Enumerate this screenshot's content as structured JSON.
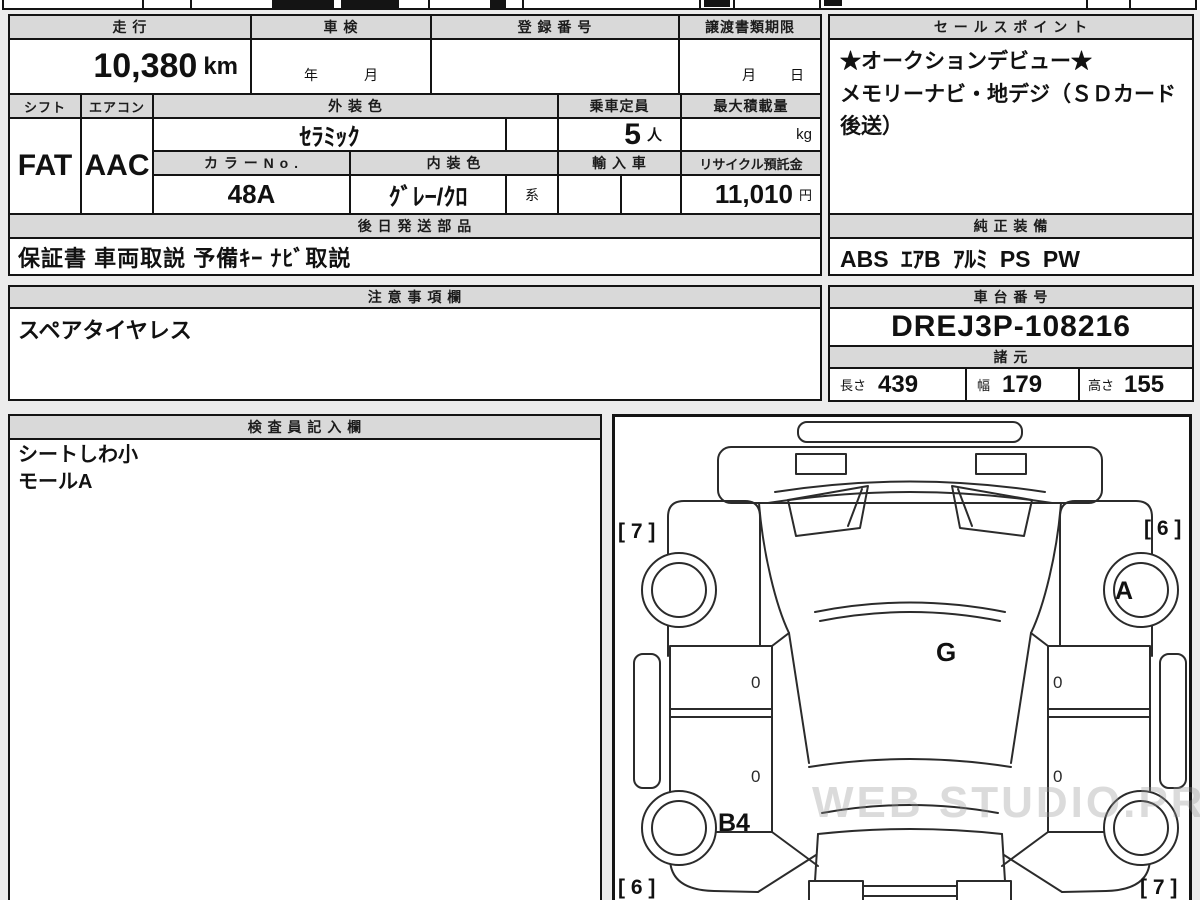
{
  "sections": {
    "mileage": {
      "label": "走 行",
      "value": "10,380",
      "unit": "km"
    },
    "inspection": {
      "label": "車 検",
      "year": "年",
      "month": "月"
    },
    "registration": {
      "label": "登 録 番 号",
      "value": ""
    },
    "deadline": {
      "label": "譲渡書類期限",
      "month": "月",
      "day": "日"
    },
    "shift": {
      "label": "シフト",
      "value": "FAT"
    },
    "aircon": {
      "label": "エアコン",
      "value": "AAC"
    },
    "exterior_color": {
      "label": "外 装 色",
      "value": "ｾﾗﾐｯｸ"
    },
    "capacity": {
      "label": "乗車定員",
      "value": "5",
      "unit": "人"
    },
    "max_load": {
      "label": "最大積載量",
      "value": "",
      "unit": "kg"
    },
    "color_no": {
      "label": "カ ラ ー N o .",
      "value": "48A"
    },
    "interior_color": {
      "label": "内 装 色",
      "value": "ｸﾞﾚｰ/ｸﾛ",
      "suffix": "系"
    },
    "import_car": {
      "label": "輸 入 車",
      "value": ""
    },
    "recycle_deposit": {
      "label": "リサイクル預託金",
      "value": "11,010",
      "unit": "円"
    },
    "shipped_later_parts": {
      "label": "後 日 発 送 部 品",
      "value": "保証書 車両取説 予備ｷｰ ﾅﾋﾞ取説"
    },
    "sales_points": {
      "label": "セ ー ル ス ポ イ ン ト",
      "line1": "★オークションデビュー★",
      "line2": "メモリーナビ・地デジ（ＳＤカード後送）"
    },
    "genuine_equipment": {
      "label": "純 正 装 備",
      "value": "ABS ｴｱB ｱﾙﾐ PS PW"
    },
    "notes": {
      "label": "注 意 事 項 欄",
      "value": "スペアタイヤレス"
    },
    "chassis_no": {
      "label": "車 台 番 号",
      "value": "DREJ3P-108216"
    },
    "specs": {
      "label": "諸 元",
      "length_label": "長さ",
      "length": "439",
      "width_label": "幅",
      "width": "179",
      "height_label": "高さ",
      "height": "155"
    },
    "inspector_notes": {
      "label": "検 査 員 記 入 欄",
      "line1": "シートしわ小",
      "line2": "モールA"
    }
  },
  "diagram": {
    "front_left": "[ 7 ]",
    "front_right": "[ 6 ]",
    "front_wheel": "A",
    "center": "G",
    "rear_quarter": "B4",
    "rear_left": "[ 6 ]",
    "rear_right": "[ 7 ]",
    "door_mark": "0"
  },
  "watermark": "WEB STUDIO.PRO",
  "colors": {
    "border": "#141414",
    "header_bg": "#d9d9d9",
    "page_bg": "#ececec",
    "cell_bg": "#ffffff"
  }
}
